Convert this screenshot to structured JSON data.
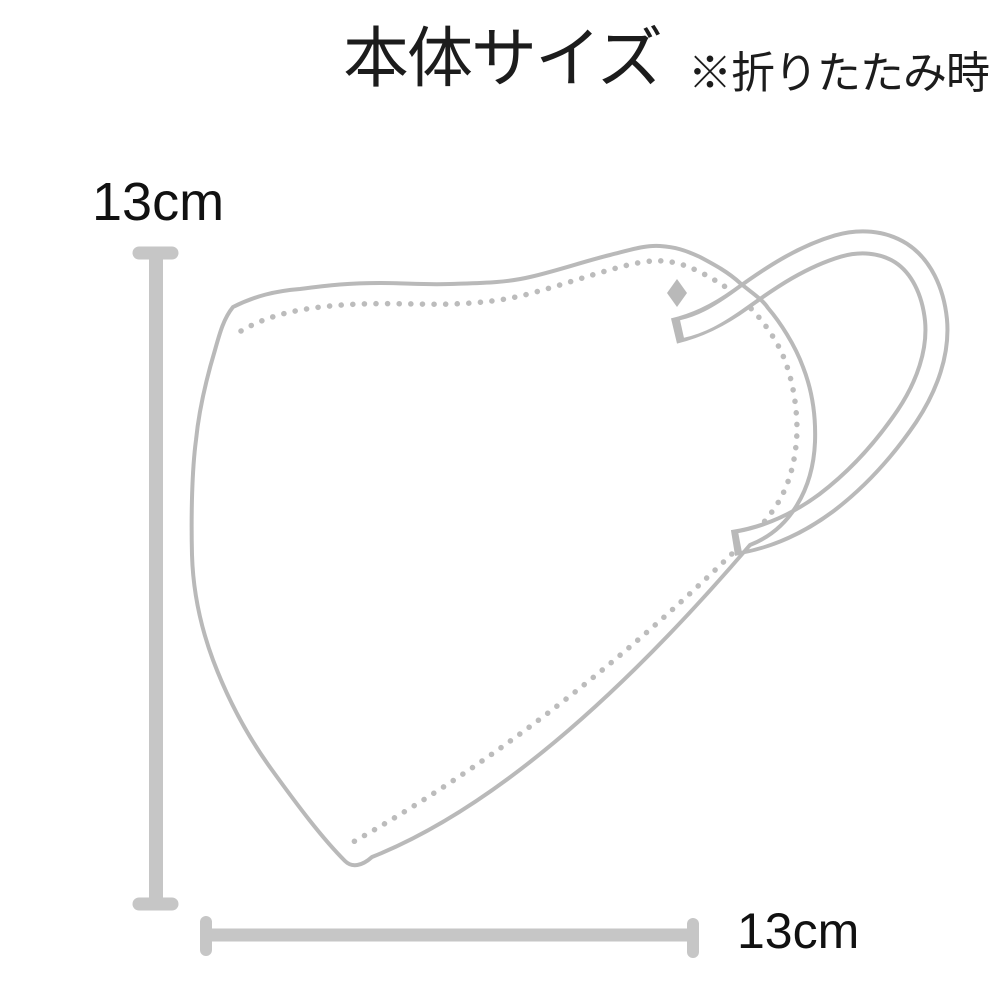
{
  "header": {
    "title": "本体サイズ",
    "note": "※折りたたみ時"
  },
  "measurements": {
    "height": {
      "label": "13cm"
    },
    "width": {
      "label": "13cm"
    }
  },
  "illustration": {
    "subject": "folded-3d-face-mask-side-view-with-ear-loop",
    "colors": {
      "mask_line": "#b9b9b9",
      "dimension_bar": "#c6c6c6",
      "text": "#1a1a1a"
    }
  }
}
